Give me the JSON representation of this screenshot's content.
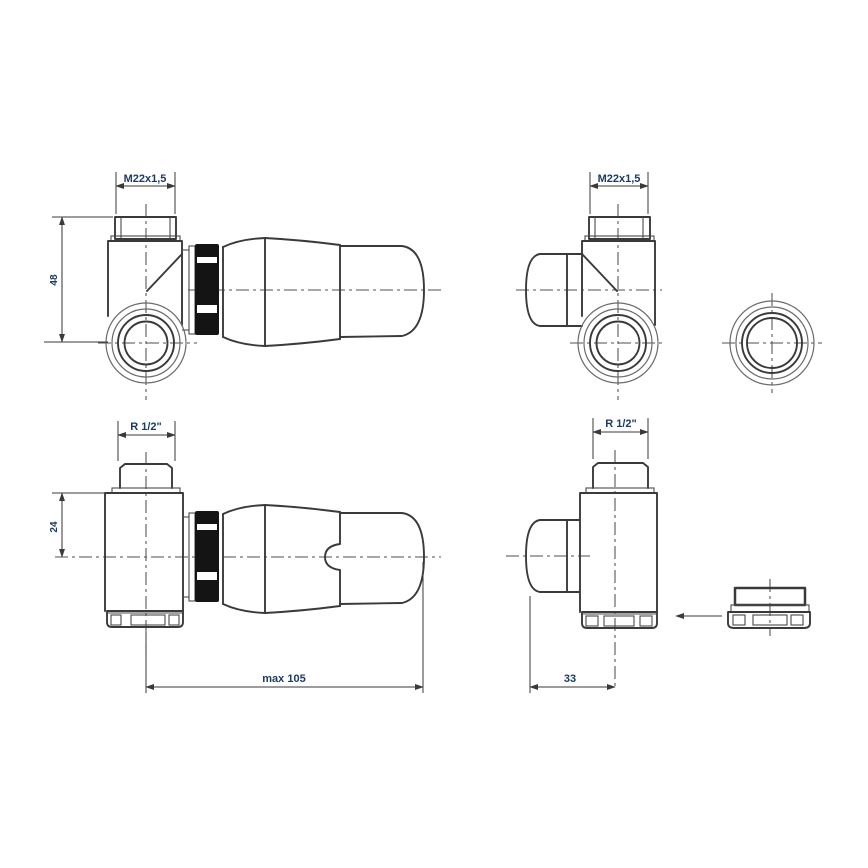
{
  "colors": {
    "label": "#1d3c63",
    "line": "#3a3a3a",
    "solid_ring": "#141414",
    "background": "#ffffff"
  },
  "labels": {
    "top_left_thread": "M22x1,5",
    "top_left_height": "48",
    "top_right_thread": "M22x1,5",
    "bottom_left_thread": "R 1/2\"",
    "bottom_left_height": "24",
    "bottom_left_max_length": "max 105",
    "bottom_right_thread": "R 1/2\"",
    "bottom_right_offset": "33"
  }
}
